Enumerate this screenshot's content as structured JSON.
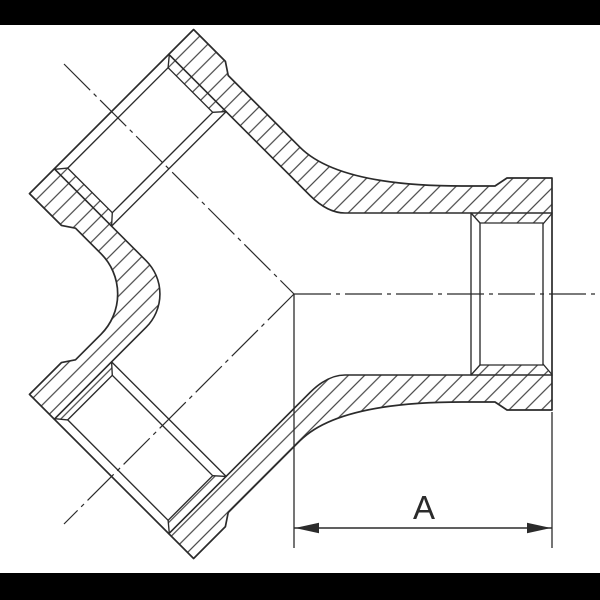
{
  "drawing": {
    "dimension_label": "A",
    "colors": {
      "line": "#2b2b2b",
      "hatch": "#2d2d2d",
      "background": "#ffffff",
      "letterbox": "#000000"
    }
  }
}
